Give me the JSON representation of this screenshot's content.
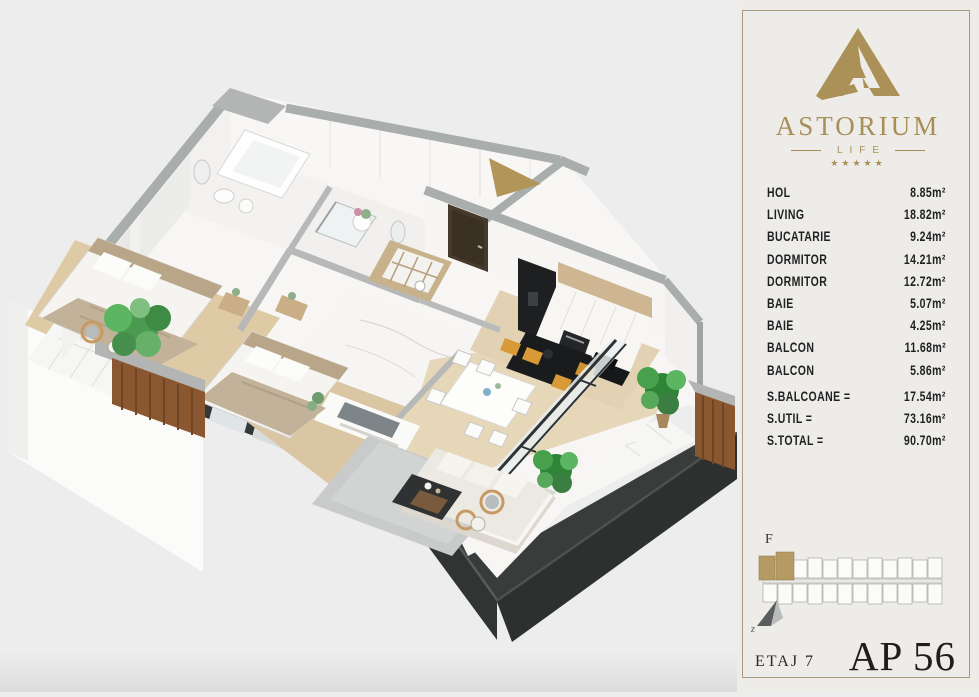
{
  "brand": {
    "name": "ASTORIUM",
    "subtitle": "LIFE",
    "stars": "★★★★★",
    "accent_color": "#a88f57"
  },
  "legend": {
    "rooms": [
      {
        "label": "HOL",
        "area": "8.85m²"
      },
      {
        "label": "LIVING",
        "area": "18.82m²"
      },
      {
        "label": "BUCATARIE",
        "area": "9.24m²"
      },
      {
        "label": "DORMITOR",
        "area": "14.21m²"
      },
      {
        "label": "DORMITOR",
        "area": "12.72m²"
      },
      {
        "label": "BAIE",
        "area": "5.07m²"
      },
      {
        "label": "BAIE",
        "area": "4.25m²"
      },
      {
        "label": "BALCON",
        "area": "11.68m²"
      },
      {
        "label": "BALCON",
        "area": "5.86m²"
      }
    ],
    "totals": [
      {
        "label": "S.BALCOANE =",
        "value": "17.54m²"
      },
      {
        "label": "S.UTIL =",
        "value": "73.16m²"
      },
      {
        "label": "S.TOTAL =",
        "value": "90.70m²"
      }
    ]
  },
  "site_plan": {
    "block_label": "F",
    "highlight_color": "#b59a63"
  },
  "compass": {
    "label": "z"
  },
  "footer": {
    "floor_label": "ETAJ 7",
    "apartment_label": "AP 56"
  },
  "colors": {
    "page_bg": "#ecedec",
    "panel_bg": "#eeece8",
    "gold_border": "#ab997b",
    "charcoal": "#383d3c",
    "wood": "#8a5731",
    "floor_wood": "#ddc8a5",
    "wall_top_gray": "#a9adac",
    "plant_green": "#3e9647",
    "stool_mustard": "#d79a37"
  }
}
